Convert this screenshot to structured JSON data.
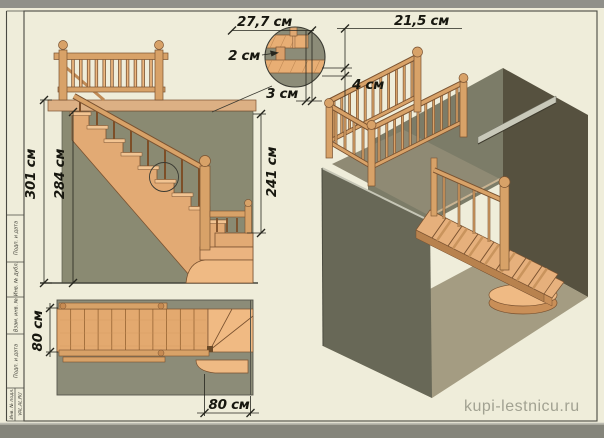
{
  "watermark": "kupi-lestnicu.ru",
  "callout": {
    "tread_depth": "27,7 см",
    "upper_dim": "21,5 см",
    "nosing": "2 см",
    "gap": "4 см",
    "overhang": "3 см"
  },
  "front_view": {
    "total_height": "301 см",
    "floor_height": "284 см",
    "opening_height": "241 см"
  },
  "plan_view": {
    "flight_width": "80 см",
    "bottom_width": "80 см"
  },
  "title_block": {
    "labels": [
      "Подп. и дата",
      "Инв. № дубл.",
      "Взам. инв. №",
      "Подп. и дата",
      "Инв. № подл."
    ],
    "brand": "VAL.AL.RU"
  }
}
